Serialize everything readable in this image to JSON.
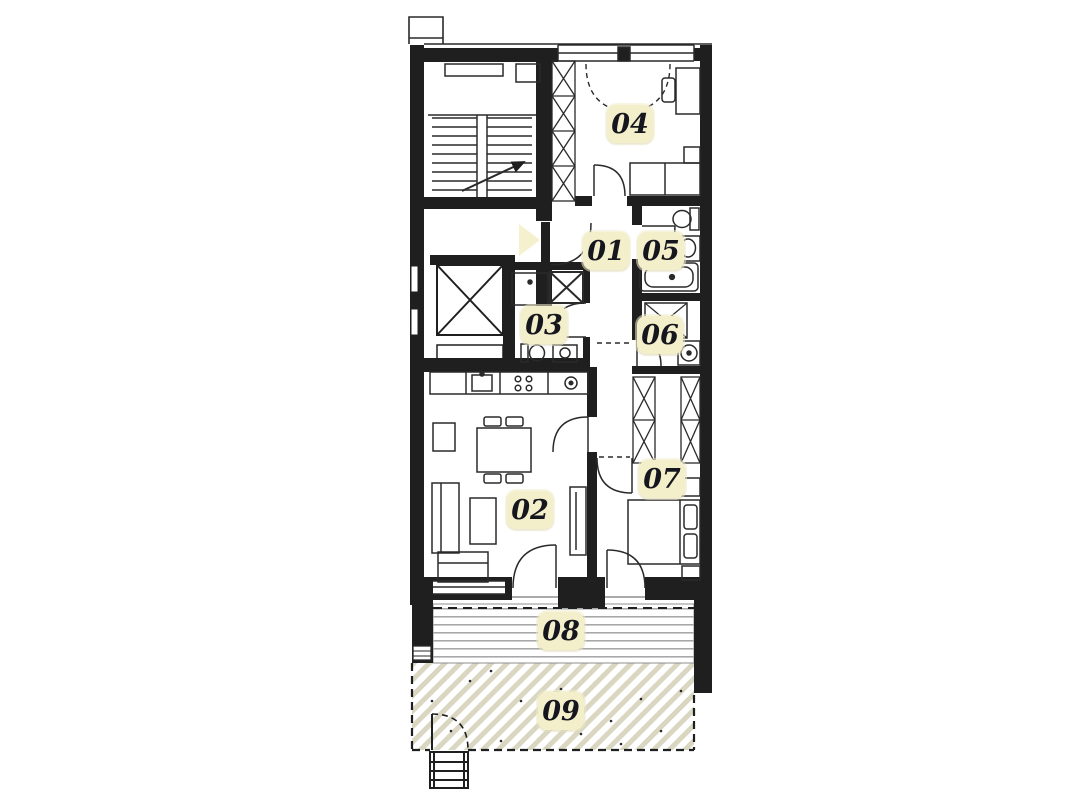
{
  "plan": {
    "type": "apartment-floor-plan",
    "rooms": [
      {
        "label": "01"
      },
      {
        "label": "02"
      },
      {
        "label": "03"
      },
      {
        "label": "04"
      },
      {
        "label": "05"
      },
      {
        "label": "06"
      },
      {
        "label": "07"
      },
      {
        "label": "08"
      },
      {
        "label": "09"
      }
    ],
    "entrance_marker": "right-pointing-triangle",
    "colors": {
      "wall": "#1f1f1f",
      "label_background": "#f3efca",
      "label_text": "#16161f",
      "entrance_marker": "#f5f1cf",
      "garden_hatch": "#d9d6c2",
      "deck_lines": "#a8a8a8"
    }
  }
}
